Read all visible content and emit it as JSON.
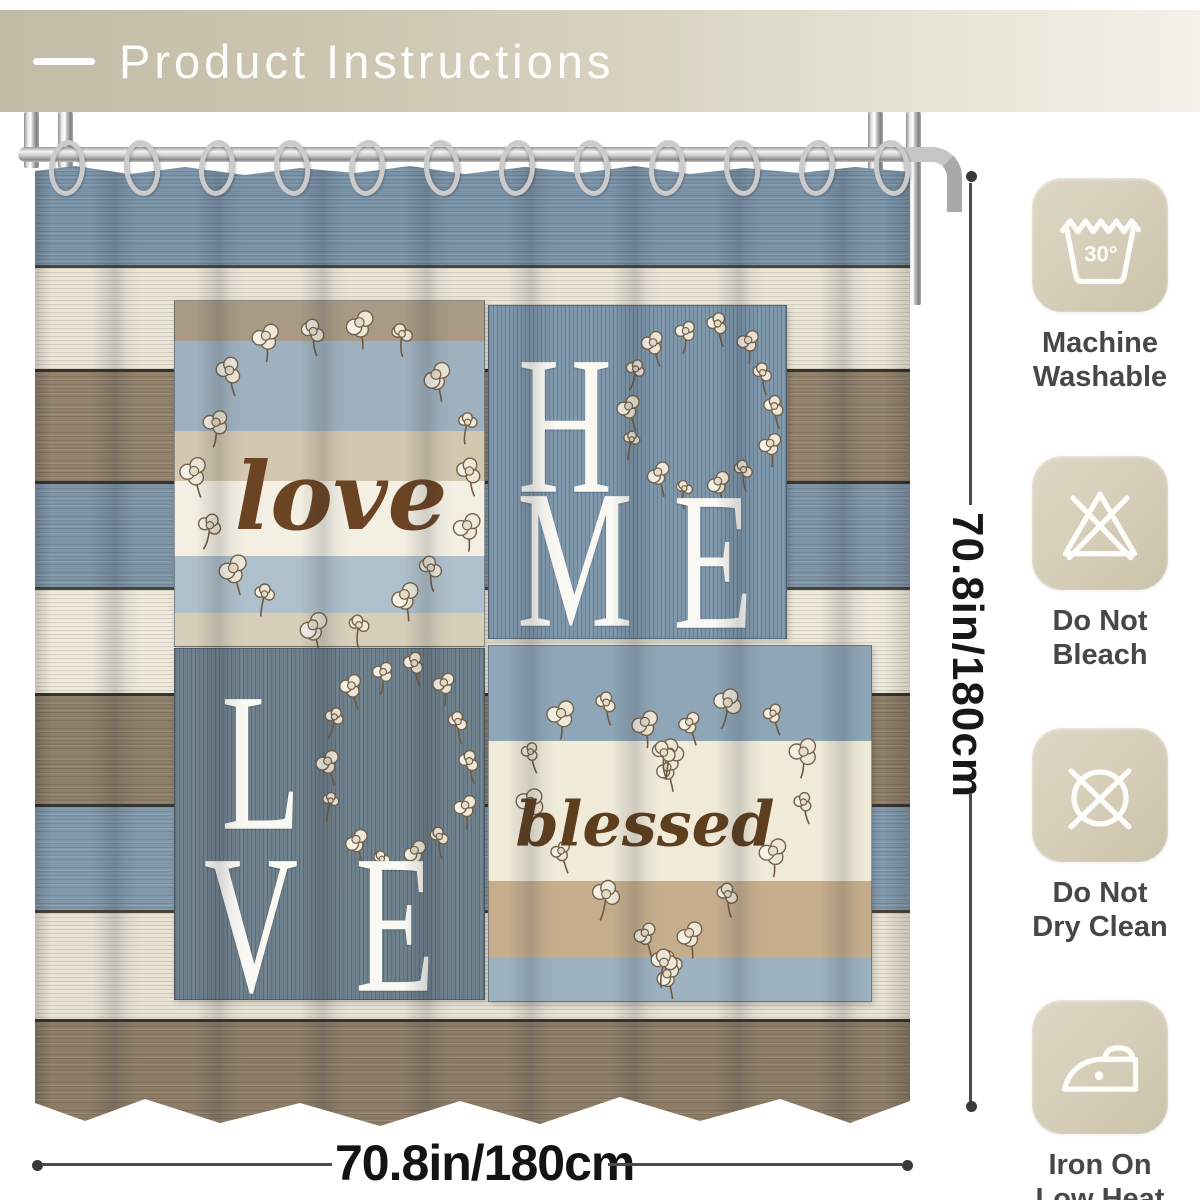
{
  "header": {
    "title": "Product Instructions"
  },
  "curtain": {
    "love_word": "love",
    "blessed_word": "blessed",
    "home_letters": [
      "H",
      "O",
      "M",
      "E"
    ],
    "love_letters": [
      "L",
      "O",
      "V",
      "E"
    ]
  },
  "dimensions": {
    "height": "70.8in/180cm",
    "width": "70.8in/180cm"
  },
  "care": {
    "items": [
      {
        "name": "machine-washable",
        "temp": "30°",
        "label": "Machine\nWashable"
      },
      {
        "name": "do-not-bleach",
        "label": "Do Not\nBleach"
      },
      {
        "name": "do-not-dry-clean",
        "label": "Do Not\nDry Clean"
      },
      {
        "name": "iron-on-low-heat",
        "label": "Iron On\nLow Heat"
      }
    ]
  },
  "colors": {
    "header_bg": "#cdc7b2",
    "care_box_bg": "#d5cdb7",
    "wood_blue": "#7d95a9",
    "wood_white": "#ebe5d8",
    "wood_taupe": "#93826c",
    "home_panel_blue": "#7e97ab",
    "love_panel_gray": "#6f808d",
    "script_brown": "#6b4423",
    "letter_white": "#faf8f2",
    "dimension_ink": "#171717",
    "label_gray": "#474747"
  }
}
